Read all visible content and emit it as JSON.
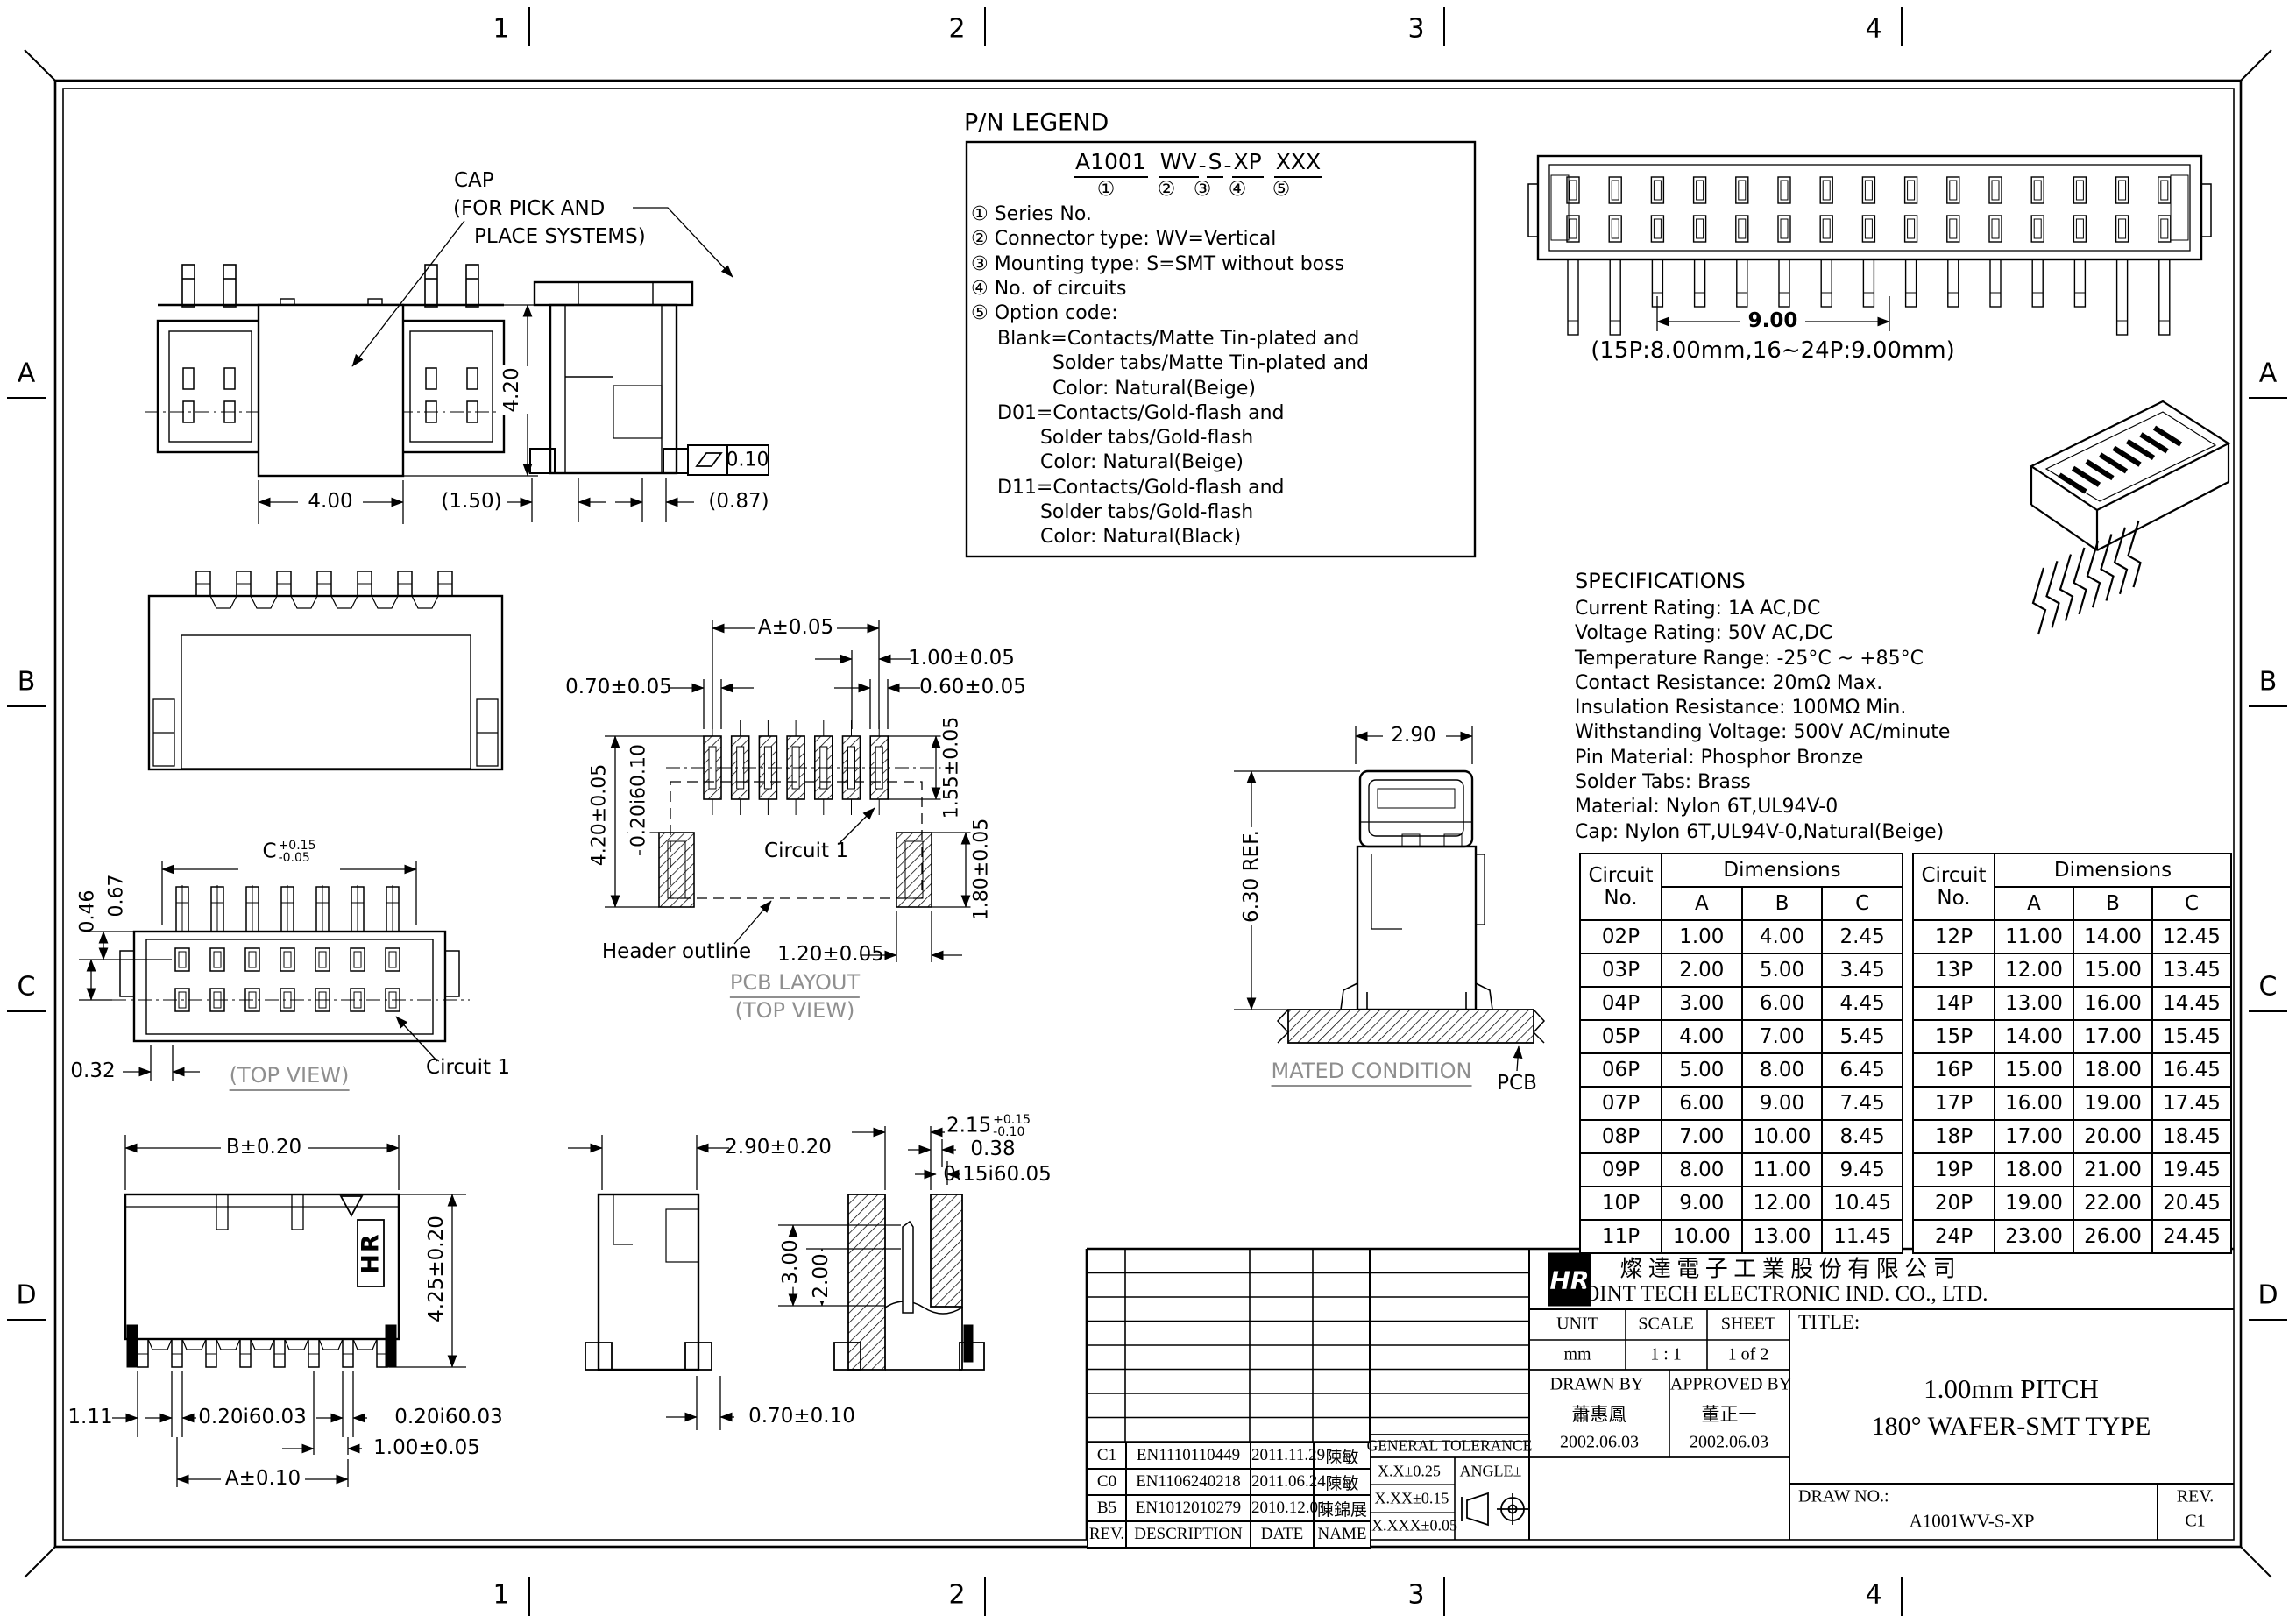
{
  "zones": {
    "h": [
      "1",
      "2",
      "3",
      "4"
    ],
    "v": [
      "A",
      "B",
      "C",
      "D"
    ]
  },
  "pn_legend": {
    "heading": "P/N LEGEND",
    "part_segments": [
      "A1001",
      "WV",
      "S",
      "XP",
      "XXX"
    ],
    "dash": "-",
    "markers": [
      "①",
      "②",
      "③",
      "④",
      "⑤"
    ],
    "items": [
      "① Series No.",
      "② Connector type: WV=Vertical",
      "③ Mounting type: S=SMT without boss",
      "④ No. of circuits",
      "⑤ Option code:"
    ],
    "options": [
      "Blank=Contacts/Matte Tin-plated and",
      "         Solder tabs/Matte Tin-plated and",
      "         Color: Natural(Beige)",
      "D01=Contacts/Gold-flash and",
      "       Solder tabs/Gold-flash",
      "       Color: Natural(Beige)",
      "D11=Contacts/Gold-flash and",
      "       Solder tabs/Gold-flash",
      "       Color: Natural(Black)"
    ]
  },
  "specifications": {
    "heading": "SPECIFICATIONS",
    "lines": [
      "Current Rating: 1A AC,DC",
      "Voltage Rating: 50V AC,DC",
      "Temperature Range: -25°C ~ +85°C",
      "Contact Resistance: 20mΩ Max.",
      "Insulation Resistance: 100MΩ Min.",
      "Withstanding Voltage: 500V AC/minute",
      "Pin Material: Phosphor Bronze",
      "Solder Tabs: Brass",
      "Material: Nylon 6T,UL94V-0",
      "Cap: Nylon 6T,UL94V-0,Natural(Beige)"
    ]
  },
  "views": {
    "front_top": {
      "cap_1": "CAP",
      "cap_2": "(FOR PICK AND",
      "cap_3": "PLACE SYSTEMS)",
      "dim_height": "4.20",
      "dim_width": "4.00"
    },
    "side_top": {
      "dim_left": "(1.50)",
      "dim_right": "(0.87)",
      "flatness": "0.10"
    },
    "header_long": {
      "dim_span": "9.00",
      "note": "(15P:8.00mm,16~24P:9.00mm)"
    },
    "top_view": {
      "c_base": "C",
      "c_plus": "+0.15",
      "c_minus": "-0.05",
      "dim_046": "0.46",
      "dim_067": "0.67",
      "dim_032": "0.32",
      "caption": "(TOP VIEW)",
      "circuit": "Circuit 1"
    },
    "pcb": {
      "dim_a": "A±0.05",
      "dim_100": "1.00±0.05",
      "dim_070": "0.70±0.05",
      "dim_060": "0.60±0.05",
      "dim_155": "1.55±0.05",
      "dim_420": "4.20±0.05",
      "dim_020": "0.20i60.10",
      "dim_180": "1.80±0.05",
      "dim_120": "1.20±0.05",
      "circuit": "Circuit 1",
      "header_outline": "Header outline",
      "caption_1": "PCB LAYOUT",
      "caption_2": "(TOP VIEW)"
    },
    "mated": {
      "dim_290": "2.90",
      "dim_630": "6.30 REF.",
      "caption": "MATED CONDITION",
      "pcb": "PCB"
    },
    "front_bottom": {
      "dim_b": "B±0.20",
      "dim_425": "4.25±0.20",
      "dim_111": "1.11",
      "dim_020_1": "0.20i60.03",
      "dim_020_2": "0.20i60.03",
      "dim_100": "1.00±0.05",
      "dim_a": "A±0.10",
      "hr_mark": "HR"
    },
    "side_bottom": {
      "dim_290": "2.90±0.20",
      "dim_070": "0.70±0.10"
    },
    "section_bottom": {
      "d215_base": "2.15",
      "d215_plus": "+0.15",
      "d215_minus": "-0.10",
      "dim_038": "0.38",
      "dim_015": "0.15i60.05",
      "dim_300": "3.00",
      "dim_200": "2.00"
    }
  },
  "tables": [
    {
      "col_circuit": "Circuit",
      "col_no": "No.",
      "col_dims": "Dimensions",
      "cols": [
        "A",
        "B",
        "C"
      ],
      "rows": [
        [
          "02P",
          "1.00",
          "4.00",
          "2.45"
        ],
        [
          "03P",
          "2.00",
          "5.00",
          "3.45"
        ],
        [
          "04P",
          "3.00",
          "6.00",
          "4.45"
        ],
        [
          "05P",
          "4.00",
          "7.00",
          "5.45"
        ],
        [
          "06P",
          "5.00",
          "8.00",
          "6.45"
        ],
        [
          "07P",
          "6.00",
          "9.00",
          "7.45"
        ],
        [
          "08P",
          "7.00",
          "10.00",
          "8.45"
        ],
        [
          "09P",
          "8.00",
          "11.00",
          "9.45"
        ],
        [
          "10P",
          "9.00",
          "12.00",
          "10.45"
        ],
        [
          "11P",
          "10.00",
          "13.00",
          "11.45"
        ]
      ]
    },
    {
      "col_circuit": "Circuit",
      "col_no": "No.",
      "col_dims": "Dimensions",
      "cols": [
        "A",
        "B",
        "C"
      ],
      "rows": [
        [
          "12P",
          "11.00",
          "14.00",
          "12.45"
        ],
        [
          "13P",
          "12.00",
          "15.00",
          "13.45"
        ],
        [
          "14P",
          "13.00",
          "16.00",
          "14.45"
        ],
        [
          "15P",
          "14.00",
          "17.00",
          "15.45"
        ],
        [
          "16P",
          "15.00",
          "18.00",
          "16.45"
        ],
        [
          "17P",
          "16.00",
          "19.00",
          "17.45"
        ],
        [
          "18P",
          "17.00",
          "20.00",
          "18.45"
        ],
        [
          "19P",
          "18.00",
          "21.00",
          "19.45"
        ],
        [
          "20P",
          "19.00",
          "22.00",
          "20.45"
        ],
        [
          "24P",
          "23.00",
          "26.00",
          "24.45"
        ]
      ]
    }
  ],
  "title_block": {
    "logo_text": "HR",
    "company_cn": "燦 達 電 子 工 業 股 份 有 限 公 司",
    "company_en": "JOINT TECH ELECTRONIC IND. CO., LTD.",
    "unit_label": "UNIT",
    "unit_value": "mm",
    "scale_label": "SCALE",
    "scale_value": "1 : 1",
    "sheet_label": "SHEET",
    "sheet_value": "1 of 2",
    "drawn_label": "DRAWN BY",
    "drawn_name": "蕭惠鳳",
    "drawn_date": "2002.06.03",
    "approved_label": "APPROVED BY",
    "approved_name": "董正一",
    "approved_date": "2002.06.03",
    "general_tolerance": "GENERAL TOLERANCE",
    "tol_1": "X.X±0.25",
    "tol_2": "X.XX±0.15",
    "tol_3": "X.XXX±0.05",
    "angle_label": "ANGLE±",
    "title_label": "TITLE:",
    "title_line1": "1.00mm PITCH",
    "title_line2": "180° WAFER-SMT TYPE",
    "draw_no_label": "DRAW NO.:",
    "draw_no_value": "A1001WV-S-XP",
    "rev_label": "REV.",
    "rev_value": "C1",
    "revisions": {
      "header": [
        "REV.",
        "DESCRIPTION",
        "DATE",
        "NAME"
      ],
      "rows": [
        [
          "C1",
          "EN1110110449",
          "2011.11.29",
          "陳敏"
        ],
        [
          "C0",
          "EN1106240218",
          "2011.06.24",
          "陳敏"
        ],
        [
          "B5",
          "EN1012010279",
          "2010.12.01",
          "陳錦展"
        ]
      ]
    }
  }
}
